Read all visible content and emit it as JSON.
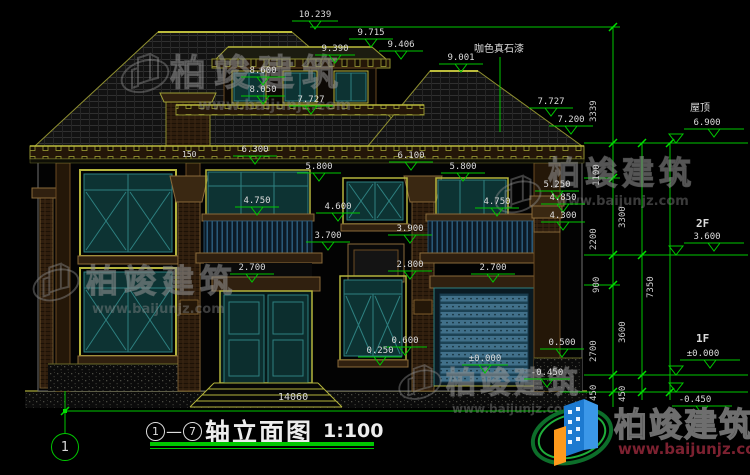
{
  "drawing": {
    "title": {
      "axis_start": "1",
      "separator": "—",
      "axis_end": "7",
      "title_text": "轴立面图",
      "scale": "1:100"
    },
    "axis_bubble_label": "1",
    "total_width_dim": "14060",
    "note_roof_material": "咖色真石漆",
    "levels": {
      "roof_label": "屋顶",
      "roof_value": "6.900",
      "f2_label": "2F",
      "f2_value": "3.600",
      "f1_label": "1F",
      "f1_value": "±0.000",
      "ground_value": "-0.450"
    }
  },
  "watermark": {
    "company": "柏竣建筑",
    "website": "www.baijunjz.com"
  },
  "logo": {
    "company": "柏竣建筑",
    "website": "www.baijunjz.com"
  },
  "colors": {
    "cad_green": "#00c800",
    "cad_text": "#dcdcdc",
    "roof_outline": "#9f9f35",
    "frame_olive": "#b4b43c",
    "glass_teal": "#0d3333",
    "mullion_teal": "#2e8080",
    "trim_brown": "#30200f",
    "shutter_blue": "#41708a",
    "logo_blue": "#1d7ad0",
    "logo_orange": "#ff9a1c",
    "url_red": "#7c2130"
  },
  "annotations": [
    {
      "t": "10.239",
      "x": 292,
      "y": 10,
      "f": 46
    },
    {
      "t": "9.715",
      "x": 348,
      "y": 28,
      "f": 44
    },
    {
      "t": "9.390",
      "x": 312,
      "y": 44,
      "f": 40
    },
    {
      "t": "9.406",
      "x": 378,
      "y": 40,
      "f": 44
    },
    {
      "t": "9.001",
      "x": 438,
      "y": 53,
      "f": 44
    },
    {
      "t": "8.600",
      "x": 240,
      "y": 66,
      "f": 44
    },
    {
      "t": "8.050",
      "x": 240,
      "y": 85,
      "f": 44
    },
    {
      "t": "7.727",
      "x": 288,
      "y": 95,
      "f": 44
    },
    {
      "t": "7.727",
      "x": 528,
      "y": 97,
      "f": 44
    },
    {
      "t": "7.200",
      "x": 548,
      "y": 115,
      "f": 44
    },
    {
      "t": "6.300",
      "x": 232,
      "y": 145,
      "f": 44
    },
    {
      "t": "6.100",
      "x": 388,
      "y": 151,
      "f": 44
    },
    {
      "t": "5.800",
      "x": 296,
      "y": 162,
      "f": 44
    },
    {
      "t": "5.800",
      "x": 440,
      "y": 162,
      "f": 44
    },
    {
      "t": "5.250",
      "x": 534,
      "y": 180,
      "f": 44
    },
    {
      "t": "4.850",
      "x": 540,
      "y": 193,
      "f": 44
    },
    {
      "t": "4.750",
      "x": 234,
      "y": 196,
      "f": 44
    },
    {
      "t": "4.750",
      "x": 474,
      "y": 197,
      "f": 44
    },
    {
      "t": "4.600",
      "x": 315,
      "y": 202,
      "f": 44
    },
    {
      "t": "4.300",
      "x": 540,
      "y": 211,
      "f": 44
    },
    {
      "t": "3.900",
      "x": 387,
      "y": 224,
      "f": 44
    },
    {
      "t": "3.700",
      "x": 305,
      "y": 231,
      "f": 44
    },
    {
      "t": "2.800",
      "x": 387,
      "y": 260,
      "f": 44
    },
    {
      "t": "2.700",
      "x": 229,
      "y": 263,
      "f": 44
    },
    {
      "t": "2.700",
      "x": 470,
      "y": 263,
      "f": 44
    },
    {
      "t": "0.600",
      "x": 382,
      "y": 336,
      "f": 44
    },
    {
      "t": "0.250",
      "x": 357,
      "y": 346,
      "f": 44
    },
    {
      "t": "0.500",
      "x": 539,
      "y": 338,
      "f": 44
    },
    {
      "t": "±0.000",
      "x": 462,
      "y": 354,
      "f": 46
    },
    {
      "t": "-0.450",
      "x": 524,
      "y": 368,
      "f": 46
    },
    {
      "t": "6.900",
      "x": 684,
      "y": 118,
      "f": 60
    },
    {
      "t": "3.600",
      "x": 684,
      "y": 232,
      "f": 60
    },
    {
      "t": "±0.000",
      "x": 680,
      "y": 349,
      "f": 60
    },
    {
      "t": "-0.450",
      "x": 672,
      "y": 395,
      "f": 60
    },
    {
      "t": "屋顶",
      "x": 690,
      "y": 104,
      "c": "cn"
    },
    {
      "t": "2F",
      "x": 696,
      "y": 219,
      "c": "lvl"
    },
    {
      "t": "1F",
      "x": 696,
      "y": 334,
      "c": "lvl"
    },
    {
      "t": "14060",
      "x": 278,
      "y": 393,
      "c": "dim"
    },
    {
      "t": "150",
      "x": 182,
      "y": 150,
      "c": "tiny"
    },
    {
      "t": "咖色真石漆",
      "x": 474,
      "y": 45,
      "c": "cn"
    },
    {
      "t": "3339",
      "x": 599,
      "y": 112,
      "c": "rot"
    },
    {
      "t": "1100",
      "x": 602,
      "y": 176,
      "c": "rot"
    },
    {
      "t": "2200",
      "x": 599,
      "y": 240,
      "c": "rot"
    },
    {
      "t": "900",
      "x": 602,
      "y": 283,
      "c": "rot"
    },
    {
      "t": "2700",
      "x": 599,
      "y": 352,
      "c": "rot"
    },
    {
      "t": "450",
      "x": 599,
      "y": 391,
      "c": "rot"
    },
    {
      "t": "3300",
      "x": 628,
      "y": 218,
      "c": "rot"
    },
    {
      "t": "3600",
      "x": 628,
      "y": 333,
      "c": "rot"
    },
    {
      "t": "450",
      "x": 628,
      "y": 392,
      "c": "rot"
    },
    {
      "t": "7350",
      "x": 656,
      "y": 288,
      "c": "rot"
    }
  ]
}
